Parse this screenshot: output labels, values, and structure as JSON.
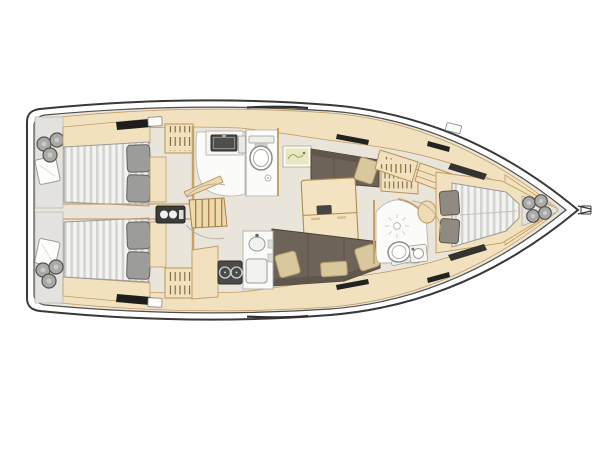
{
  "meta": {
    "title": "Sailing yacht interior layout plan, top view, bow pointing right",
    "view": "overhead floor plan drawing",
    "visible_text": "none"
  },
  "palette": {
    "background": "#ffffff",
    "hull_outline": "#383838",
    "floor": "#eae5db",
    "cabinetry": "#f1e1bf",
    "cabinetry_outline": "#c19b61",
    "wood_trim": "#c6a265",
    "table": "#f3e3c1",
    "upholstery": "#6e6358",
    "upholstery_dark": "#5f574c",
    "cushion_beige": "#d9c79e",
    "mattress_white": "#f3f3f2",
    "mattress_stripe": "#d3d3d0",
    "pillow_gray": "#9c9c9a",
    "fixture_white": "#fbfbfa",
    "appliance_dark": "#4a4a48",
    "deck_gray": "#e3e2df",
    "fender_gray": "#a9a9a7",
    "hatch_black": "#1d1d1b",
    "chart_green": "#e9e8c2"
  },
  "rooms": {
    "aft_cabin_port": {
      "label": "Aft cabin port",
      "features": [
        "double berth with striped mattress",
        "2 gray pillows",
        "wardrobe with hangers",
        "black deck hatch"
      ]
    },
    "aft_cabin_starboard": {
      "label": "Aft cabin starboard",
      "features": [
        "double berth with striped mattress",
        "2 gray pillows",
        "wardrobe with hangers",
        "black deck hatch"
      ]
    },
    "stern_deck": {
      "label": "Stern deck",
      "features": [
        "3 fenders top",
        "3 fenders bottom",
        "2 white cushions"
      ]
    },
    "aft_head": {
      "label": "Aft head",
      "features": [
        "vanity with dark sink",
        "toilet with cistern",
        "shower drain",
        "door with swing arc"
      ]
    },
    "companionway": {
      "label": "Companionway",
      "features": [
        "6-step stairs",
        "engine instrument panel with 2 dials"
      ]
    },
    "saloon": {
      "label": "Saloon",
      "features": [
        "folding table with mast block",
        "port settee with 1 cushion",
        "long starboard settee with 3 cushions",
        "bottle rack",
        "framed chart picture"
      ]
    },
    "galley": {
      "label": "Galley",
      "features": [
        "2-burner stove",
        "round sink with faucet",
        "square basin",
        "L-shaped counter"
      ]
    },
    "forward_head": {
      "label": "Forward head",
      "features": [
        "shower drain with rays",
        "toilet",
        "corner washbasin",
        "curved partition",
        "door swing arc"
      ]
    },
    "forward_cabin": {
      "label": "Forward cabin",
      "features": [
        "V-berth with striped mattress",
        "2 pillows",
        "wardrobe with hangers",
        "shelf unit",
        "stool seat"
      ]
    },
    "bow_deck": {
      "label": "Bow deck",
      "features": [
        "4 fenders",
        "anchor fitting at stem"
      ]
    }
  },
  "counts": {
    "berths": 3,
    "heads": 2,
    "settee_cushions": 4,
    "stove_burners": 2,
    "stern_fenders": 6,
    "bow_fenders": 4,
    "stair_steps": 6,
    "hull_windows": 6
  }
}
